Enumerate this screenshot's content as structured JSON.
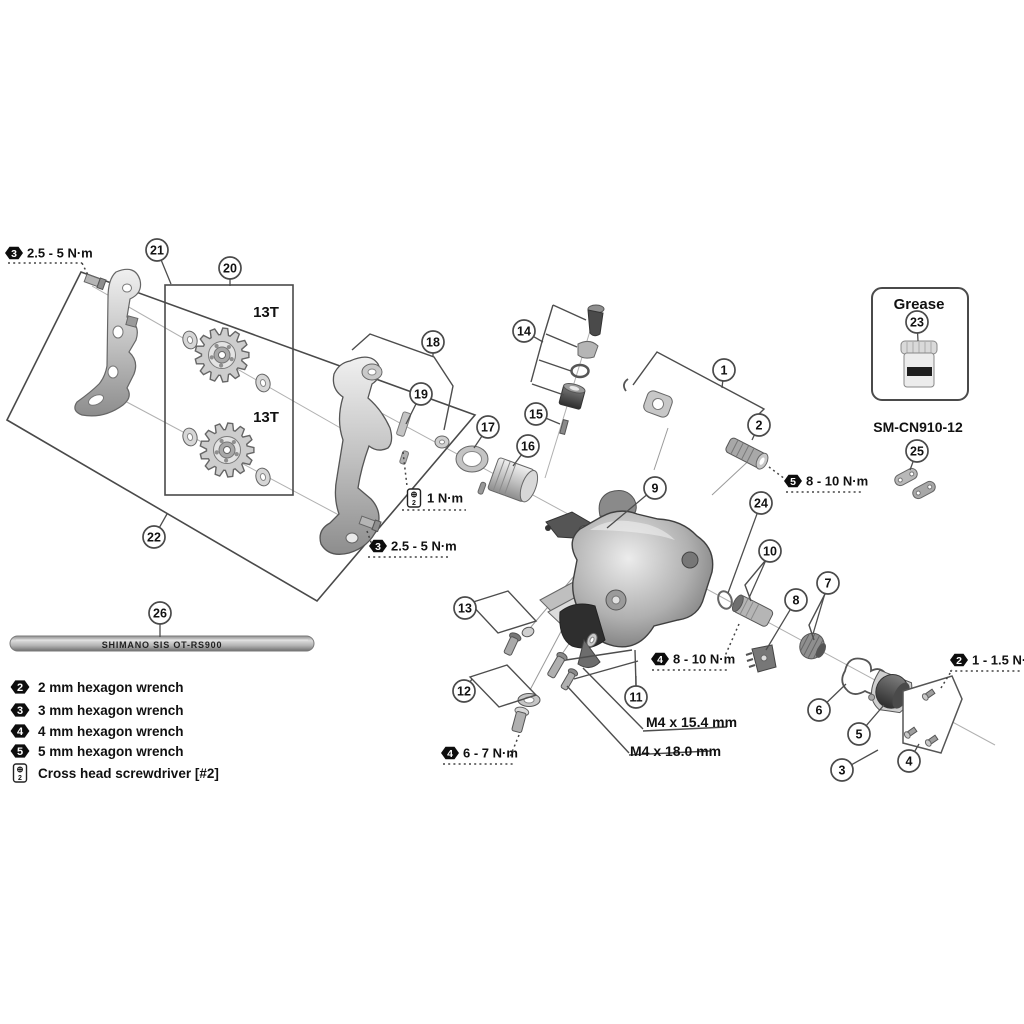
{
  "diagram_title": "rear-derailleur-exploded-view",
  "callouts": [
    {
      "n": "1",
      "x": 724,
      "y": 370,
      "tx": 722,
      "ty": 388
    },
    {
      "n": "2",
      "x": 759,
      "y": 425,
      "tx": 752,
      "ty": 440
    },
    {
      "n": "3",
      "x": 842,
      "y": 770,
      "tx": 878,
      "ty": 750
    },
    {
      "n": "4",
      "x": 909,
      "y": 761,
      "tx": 919,
      "ty": 744
    },
    {
      "n": "5",
      "x": 859,
      "y": 734,
      "tx": 884,
      "ty": 705
    },
    {
      "n": "6",
      "x": 819,
      "y": 710,
      "tx": 846,
      "ty": 684
    },
    {
      "n": "7",
      "x": 828,
      "y": 583,
      "tx": 813,
      "ty": 634
    },
    {
      "n": "8",
      "x": 796,
      "y": 600,
      "tx": 766,
      "ty": 650
    },
    {
      "n": "9",
      "x": 655,
      "y": 488,
      "tx": 607,
      "ty": 528
    },
    {
      "n": "10",
      "x": 770,
      "y": 551,
      "tx": 749,
      "ty": 598
    },
    {
      "n": "11",
      "x": 636,
      "y": 697,
      "tx": 636,
      "ty": 676
    },
    {
      "n": "12",
      "x": 464,
      "y": 691,
      "tx": 472,
      "ty": 679
    },
    {
      "n": "13",
      "x": 465,
      "y": 608,
      "tx": 473,
      "ty": 603
    },
    {
      "n": "14",
      "x": 524,
      "y": 331,
      "tx": 543,
      "ty": 342
    },
    {
      "n": "15",
      "x": 536,
      "y": 414,
      "tx": 560,
      "ty": 424
    },
    {
      "n": "16",
      "x": 528,
      "y": 446,
      "tx": 513,
      "ty": 466
    },
    {
      "n": "17",
      "x": 488,
      "y": 427,
      "tx": 474,
      "ty": 448
    },
    {
      "n": "18",
      "x": 433,
      "y": 342,
      "tx": 433,
      "ty": 356
    },
    {
      "n": "19",
      "x": 421,
      "y": 394,
      "tx": 406,
      "ty": 424
    },
    {
      "n": "20",
      "x": 230,
      "y": 268,
      "tx": 230,
      "ty": 286
    },
    {
      "n": "21",
      "x": 157,
      "y": 250,
      "tx": 171,
      "ty": 284
    },
    {
      "n": "22",
      "x": 154,
      "y": 537,
      "tx": 167,
      "ty": 514
    },
    {
      "n": "23",
      "x": 917,
      "y": 322,
      "tx": 918,
      "ty": 341
    },
    {
      "n": "24",
      "x": 761,
      "y": 503,
      "tx": 728,
      "ty": 593
    },
    {
      "n": "25",
      "x": 917,
      "y": 451,
      "tx": 910,
      "ty": 470
    },
    {
      "n": "26",
      "x": 160,
      "y": 613,
      "tx": 160,
      "ty": 637
    }
  ],
  "torque_labels": [
    {
      "id": "torque-hinge-plate-upper",
      "tool": "3",
      "text": "2.5 - 5 N·m",
      "hx": 14,
      "hy": 253,
      "underline": [
        8,
        263,
        82,
        263
      ],
      "dash": [
        82,
        263,
        89,
        277
      ]
    },
    {
      "id": "torque-stopper-screw",
      "tool": "ph",
      "text": "1 N·m",
      "hx": 414,
      "hy": 498,
      "underline": [
        402,
        510,
        466,
        510
      ],
      "dash": [
        403,
        452,
        407,
        486
      ]
    },
    {
      "id": "torque-hinge-plate-lower",
      "tool": "3",
      "text": "2.5 - 5 N·m",
      "hx": 378,
      "hy": 546,
      "underline": [
        368,
        557,
        450,
        557
      ],
      "dash": [
        367,
        531,
        372,
        545
      ]
    },
    {
      "id": "torque-cable-clamp",
      "tool": "5",
      "text": "8 - 10 N·m",
      "hx": 793,
      "hy": 481,
      "underline": [
        786,
        492,
        862,
        492
      ],
      "dash": [
        769,
        467,
        785,
        479
      ]
    },
    {
      "id": "torque-cartridge",
      "tool": "4",
      "text": "8 - 10 N·m",
      "hx": 660,
      "hy": 659,
      "underline": [
        652,
        670,
        727,
        670
      ],
      "dash": [
        739,
        624,
        725,
        656
      ]
    },
    {
      "id": "torque-bracket-bolt",
      "tool": "4",
      "text": "6 - 7 N·m",
      "hx": 450,
      "hy": 753,
      "underline": [
        443,
        764,
        513,
        764
      ],
      "dash": [
        519,
        735,
        510,
        757
      ]
    },
    {
      "id": "torque-cover-screws",
      "tool": "2",
      "text": "1 - 1.5 N·m",
      "hx": 959,
      "hy": 660,
      "underline": [
        950,
        671,
        1022,
        671
      ],
      "dash": [
        941,
        688,
        952,
        670
      ]
    }
  ],
  "part_labels": [
    {
      "id": "pulley-top-teeth",
      "text": "13T",
      "x": 266,
      "y": 317,
      "size": 15,
      "anchor": "middle",
      "weight": "bold",
      "fill": "#111"
    },
    {
      "id": "pulley-bottom-teeth",
      "text": "13T",
      "x": 266,
      "y": 422,
      "size": 15,
      "anchor": "middle",
      "weight": "bold",
      "fill": "#111"
    },
    {
      "id": "bolt-spec-upper",
      "text": "M4 x 15.4 mm",
      "x": 646,
      "y": 727,
      "size": 14,
      "anchor": "start",
      "weight": "bold",
      "fill": "#111"
    },
    {
      "id": "bolt-spec-lower",
      "text": "M4 x 18.0 mm",
      "x": 630,
      "y": 756,
      "size": 14,
      "anchor": "start",
      "weight": "bold",
      "fill": "#111"
    },
    {
      "id": "grease-title",
      "text": "Grease",
      "x": 919,
      "y": 309,
      "size": 15,
      "anchor": "middle",
      "weight": "bold",
      "fill": "#111"
    },
    {
      "id": "chain-link-model",
      "text": "SM-CN910-12",
      "x": 918,
      "y": 432,
      "size": 14,
      "anchor": "middle",
      "weight": "bold",
      "fill": "#111"
    },
    {
      "id": "cable-marking",
      "text": "SHIMANO SIS OT-RS900",
      "x": 162,
      "y": 648,
      "size": 9,
      "anchor": "middle",
      "weight": "bold",
      "fill": "#efefef"
    }
  ],
  "legend": [
    {
      "tool": "2",
      "text": "2 mm hexagon wrench"
    },
    {
      "tool": "3",
      "text": "3 mm hexagon wrench"
    },
    {
      "tool": "4",
      "text": "4 mm hexagon wrench"
    },
    {
      "tool": "5",
      "text": "5 mm hexagon wrench"
    },
    {
      "tool": "ph",
      "text": "Cross head screwdriver [#2]"
    }
  ],
  "colors": {
    "line": "#4d4d4d",
    "metal_light": "#e8e8e8",
    "metal_mid": "#b5b5b5",
    "metal_dark": "#3f3f3f",
    "tool_icon": "#0d0d0d"
  }
}
